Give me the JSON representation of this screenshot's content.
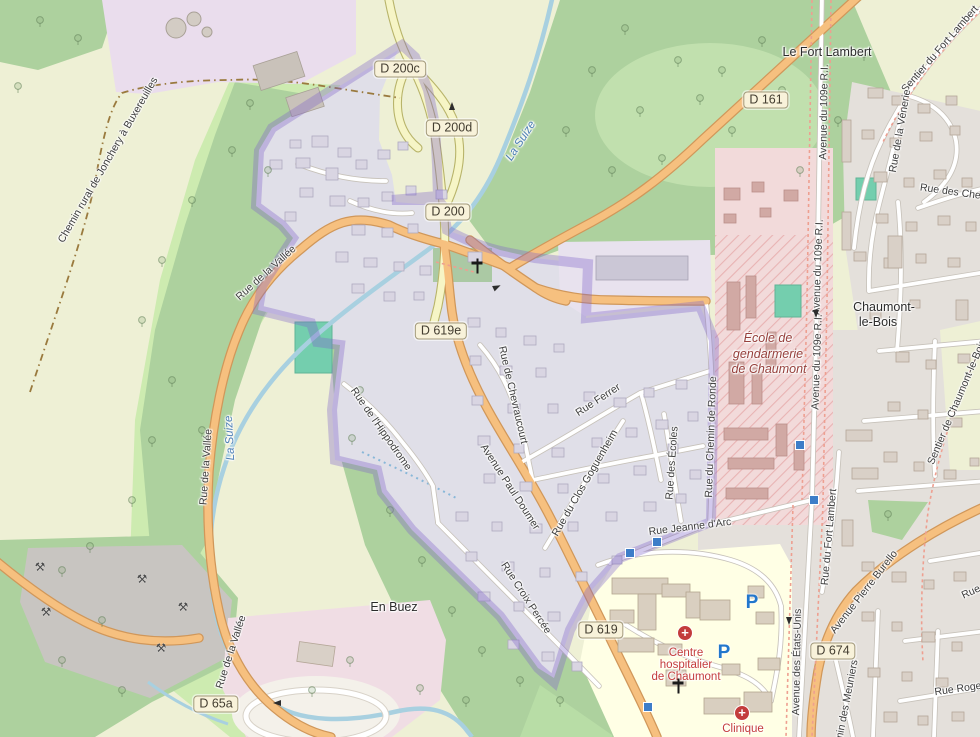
{
  "map": {
    "colors": {
      "boundary_purple": "#6a4fc5",
      "water_blue": "#a8d0e0",
      "primary_road_orange": "#f6c07f",
      "secondary_road_yellow": "#f6f5c6",
      "hospital_red": "#c43c3c",
      "school_maroon": "#96403c",
      "parking_blue": "#2277cc",
      "woods_green": "#add19e",
      "grass_green": "#cdebb0",
      "farmland": "#eef0d5"
    },
    "road_badges": [
      {
        "text": "D 200c",
        "x": 400,
        "y": 69
      },
      {
        "text": "D 200d",
        "x": 452,
        "y": 128
      },
      {
        "text": "D 200",
        "x": 448,
        "y": 212
      },
      {
        "text": "D 619e",
        "x": 441,
        "y": 331
      },
      {
        "text": "D 619",
        "x": 601,
        "y": 630
      },
      {
        "text": "D 161",
        "x": 766,
        "y": 100
      },
      {
        "text": "D 674",
        "x": 833,
        "y": 651
      },
      {
        "text": "D 65a",
        "x": 216,
        "y": 704
      }
    ],
    "street_labels": [
      {
        "text": "Chemin rural de Jonchery à Buxereuilles",
        "x": 108,
        "y": 160,
        "rot": -60
      },
      {
        "text": "Sentier du Fort Lambert",
        "x": 940,
        "y": 49,
        "rot": -49
      },
      {
        "text": "Rue de la Vénerie",
        "x": 900,
        "y": 131,
        "rot": -80
      },
      {
        "text": "Rue des Chev",
        "x": 953,
        "y": 192,
        "rot": 8
      },
      {
        "text": "Avenue du 109e R.I.",
        "x": 824,
        "y": 112,
        "rot": -89
      },
      {
        "text": "Avenue du 109e R.I.",
        "x": 818,
        "y": 267,
        "rot": -88
      },
      {
        "text": "Avenue du 109e R.I.",
        "x": 817,
        "y": 362,
        "rot": -88
      },
      {
        "text": "Sentier de Chaumont-le-Bois",
        "x": 957,
        "y": 402,
        "rot": -67
      },
      {
        "text": "Rue de la Vallée",
        "x": 266,
        "y": 273,
        "rot": -42
      },
      {
        "text": "Rue de la Vallée",
        "x": 206,
        "y": 467,
        "rot": -86
      },
      {
        "text": "Rue de la Vallée",
        "x": 231,
        "y": 652,
        "rot": -72
      },
      {
        "text": "Rue de l'Hippodrome",
        "x": 381,
        "y": 429,
        "rot": 55
      },
      {
        "text": "Avenue Paul Doumer",
        "x": 510,
        "y": 487,
        "rot": 57
      },
      {
        "text": "Rue de Chevraucourt",
        "x": 513,
        "y": 395,
        "rot": 77
      },
      {
        "text": "Rue Ferrer",
        "x": 598,
        "y": 400,
        "rot": -33
      },
      {
        "text": "Rue du Clos Goguenheim",
        "x": 585,
        "y": 483,
        "rot": -60
      },
      {
        "text": "Rue des Écoles",
        "x": 672,
        "y": 463,
        "rot": -86
      },
      {
        "text": "Rue Jeanne d'Arc",
        "x": 690,
        "y": 527,
        "rot": -7
      },
      {
        "text": "Rue du Chemin de Ronde",
        "x": 711,
        "y": 437,
        "rot": -88
      },
      {
        "text": "Rue Croix Percée",
        "x": 526,
        "y": 598,
        "rot": 57
      },
      {
        "text": "Avenue des États-Unis",
        "x": 797,
        "y": 662,
        "rot": -89
      },
      {
        "text": "Rue du Fort Lambert",
        "x": 829,
        "y": 537,
        "rot": -85
      },
      {
        "text": "Avenue Pierre Burello",
        "x": 864,
        "y": 592,
        "rot": -52
      },
      {
        "text": "Chemin des Meuniers",
        "x": 845,
        "y": 710,
        "rot": -79
      },
      {
        "text": "Rue Roge",
        "x": 958,
        "y": 689,
        "rot": -8
      },
      {
        "text": "Rue",
        "x": 971,
        "y": 592,
        "rot": -25
      }
    ],
    "place_labels": [
      {
        "text": "Le Fort Lambert",
        "x": 827,
        "y": 52
      },
      {
        "text": "Chaumont-",
        "x": 884,
        "y": 307
      },
      {
        "text": "le-Bois",
        "x": 878,
        "y": 322
      },
      {
        "text": "En Buez",
        "x": 394,
        "y": 607
      }
    ],
    "water_labels": [
      {
        "text": "La Suize",
        "x": 521,
        "y": 141,
        "rot": -57
      },
      {
        "text": "La Suize",
        "x": 230,
        "y": 438,
        "rot": -93
      }
    ],
    "school_labels": [
      {
        "text": "École de",
        "x": 768,
        "y": 338
      },
      {
        "text": "gendarmerie",
        "x": 768,
        "y": 354
      },
      {
        "text": "de Chaumont",
        "x": 769,
        "y": 369
      }
    ],
    "hospital_labels": [
      {
        "text": "Centre",
        "x": 686,
        "y": 653
      },
      {
        "text": "hospitalier",
        "x": 686,
        "y": 665
      },
      {
        "text": "de Chaumont",
        "x": 686,
        "y": 677
      },
      {
        "text": "Clinique",
        "x": 743,
        "y": 729
      }
    ],
    "parking_labels": [
      {
        "text": "P",
        "x": 752,
        "y": 603
      },
      {
        "text": "P",
        "x": 724,
        "y": 653
      }
    ],
    "icon_glyphs": {
      "pickaxe": "⚒"
    },
    "icons": [
      {
        "type": "hospital-cross",
        "x": 685,
        "y": 633
      },
      {
        "type": "hospital-cross",
        "x": 742,
        "y": 713
      },
      {
        "type": "church-cross",
        "x": 477,
        "y": 266
      },
      {
        "type": "church-cross",
        "x": 678,
        "y": 686
      },
      {
        "type": "quarry-pickaxe",
        "x": 40,
        "y": 567
      },
      {
        "type": "quarry-pickaxe",
        "x": 142,
        "y": 579
      },
      {
        "type": "quarry-pickaxe",
        "x": 183,
        "y": 607
      },
      {
        "type": "quarry-pickaxe",
        "x": 46,
        "y": 612
      },
      {
        "type": "quarry-pickaxe",
        "x": 161,
        "y": 648
      },
      {
        "type": "oneway-arrow",
        "x": 452,
        "y": 106,
        "rot": -90
      },
      {
        "type": "oneway-arrow",
        "x": 497,
        "y": 287,
        "rot": -25
      },
      {
        "type": "oneway-arrow",
        "x": 816,
        "y": 314,
        "rot": 90
      },
      {
        "type": "oneway-arrow",
        "x": 789,
        "y": 621,
        "rot": 90
      },
      {
        "type": "oneway-arrow",
        "x": 277,
        "y": 703,
        "rot": 180
      },
      {
        "type": "bus-stop",
        "x": 800,
        "y": 445
      },
      {
        "type": "bus-stop",
        "x": 814,
        "y": 500
      },
      {
        "type": "bus-stop",
        "x": 657,
        "y": 542
      },
      {
        "type": "bus-stop",
        "x": 630,
        "y": 553
      },
      {
        "type": "bus-stop",
        "x": 648,
        "y": 707
      }
    ]
  }
}
